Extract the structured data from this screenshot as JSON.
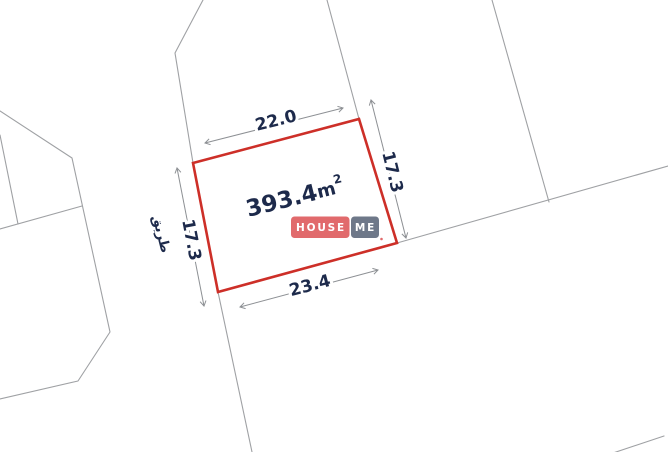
{
  "page": {
    "background": "#ffffff",
    "description": "Cadastral land plot survey drawing with dimensions"
  },
  "plot": {
    "area_value": "393.4",
    "area_unit": "m",
    "area_exponent": "2",
    "dimensions": {
      "top": "22.0",
      "right": "17.3",
      "bottom": "23.4",
      "left": "17.3"
    },
    "road_label": "طريق",
    "outline_color": "#cd2f28",
    "label_color": "#1d2a4b",
    "boundary_line_color": "#9fa1a4",
    "dimension_line_color": "#8d9094"
  },
  "watermark": {
    "left_word": "HOUSE",
    "right_word": "ME",
    "left_bg": "#e16a6c",
    "right_bg": "#6e7889",
    "text_color": "#ffffff"
  }
}
